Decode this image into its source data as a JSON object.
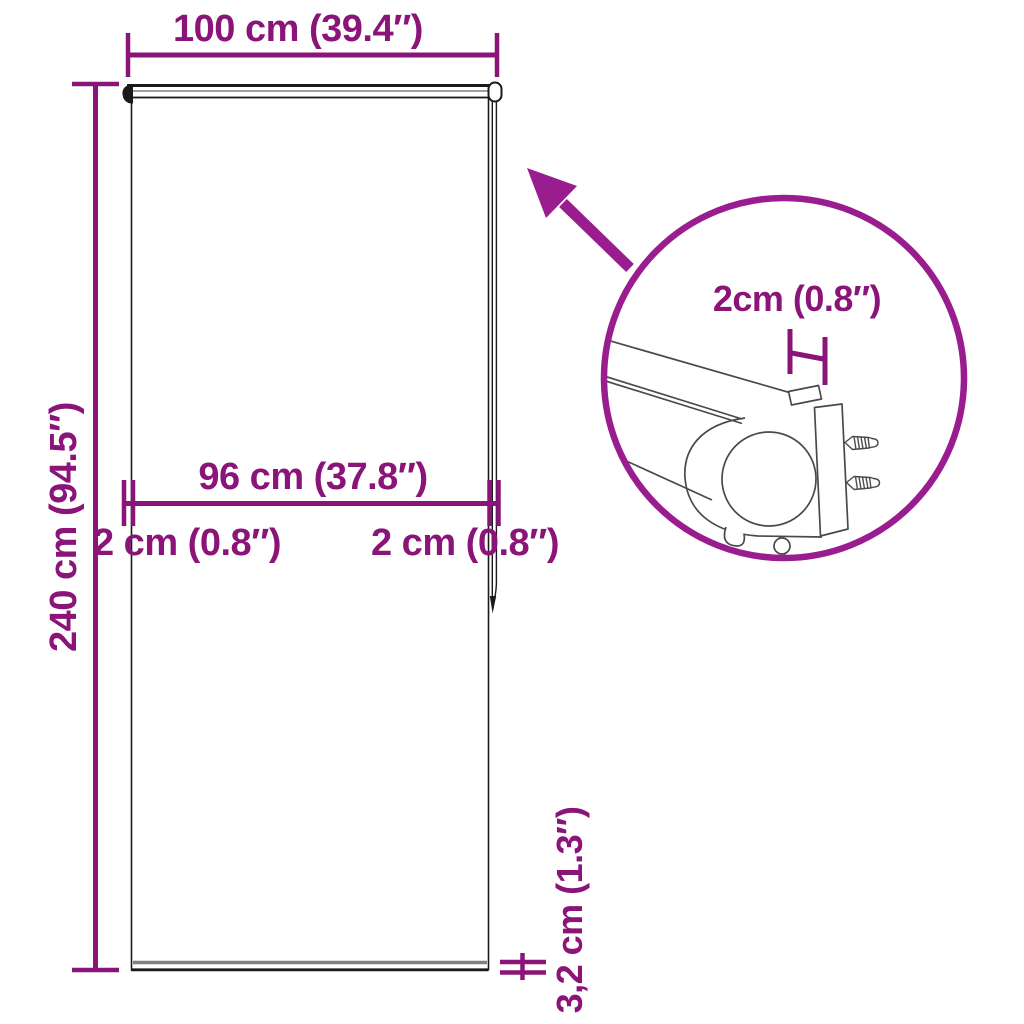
{
  "diagram": {
    "type": "product-dimension-diagram",
    "subject": "roller-blind",
    "dimensions": {
      "total_width": "100 cm (39.4″)",
      "total_height": "240 cm (94.5″)",
      "fabric_width": "96 cm (37.8″)",
      "left_offset": "2 cm (0.8″)",
      "right_offset": "2 cm (0.8″)",
      "bottom_bar_height": "3,2 cm (1.3″)",
      "bracket_depth": "2cm (0.8″)"
    }
  },
  "colors": {
    "dim": "#8A1478",
    "accent": "#9A1D8F",
    "line": "#1A1A1A",
    "detail": "#4A4A4A",
    "bargray": "#7F7F7F",
    "bg": "#FFFFFF"
  }
}
